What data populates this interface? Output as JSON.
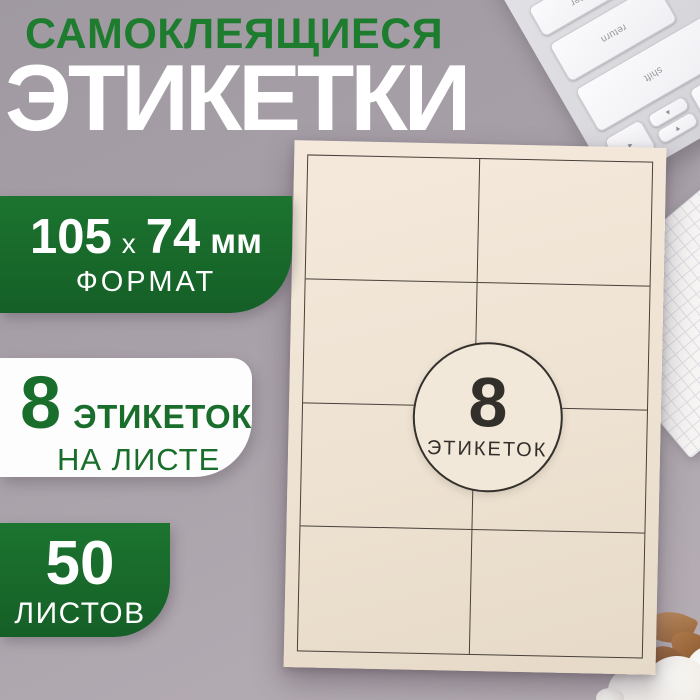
{
  "product": {
    "title_line1": "САМОКЛЕЯЩИЕСЯ",
    "title_line2": "ЭТИКЕТКИ"
  },
  "badges": {
    "format": {
      "width_mm": "105",
      "times": "х",
      "height_mm": "74",
      "unit": "мм",
      "caption": "ФОРМАТ"
    },
    "per_sheet": {
      "count": "8",
      "label": "ЭТИКЕТОК",
      "sublabel": "НА ЛИСТЕ"
    },
    "sheets": {
      "count": "50",
      "label": "ЛИСТОВ"
    }
  },
  "sheet": {
    "sticker_count": "8",
    "sticker_label": "ЭТИКЕТОК",
    "grid_rows": 4,
    "grid_cols": 2
  },
  "keyboard": {
    "wide_keys": [
      "enter",
      "return",
      "shift"
    ],
    "arrow_keys": [
      "◄",
      "▲",
      "▼",
      "►"
    ],
    "symbol_keys": [
      "}",
      "]",
      "э",
      "ж",
      ";",
      "?",
      "ю",
      "б"
    ],
    "command_key": "command"
  },
  "colors": {
    "background": "#a9a1a9",
    "accent_green": "#18682a",
    "title_green": "#1e7c2f",
    "sheet_cream": "#eee2d2",
    "text_white": "#ffffff",
    "sticker_ink": "#33302c"
  }
}
